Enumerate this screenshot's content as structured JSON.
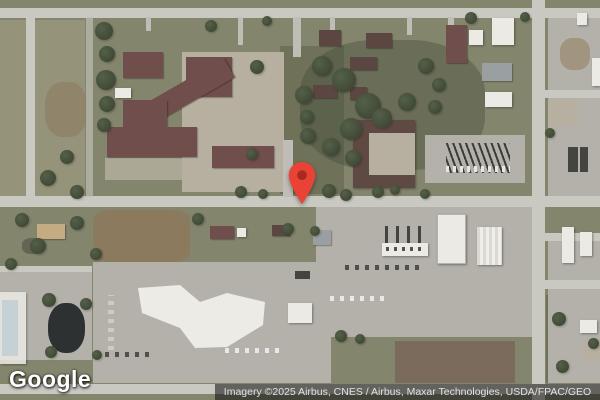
{
  "branding": {
    "logo_text": "Google"
  },
  "attribution": {
    "text": "Imagery ©2025 Airbus, CNES / Airbus, Maxar Technologies, USDA/FPAC/GEO"
  },
  "marker": {
    "color": "#EA4335",
    "dot_color": "#A52B1E"
  },
  "colors": {
    "grass": "#84856d",
    "road": "#c9c8c1",
    "parking": "#b3b1a9",
    "dirt_field": "#8c7a5f",
    "building_roof": "#6f4e4b",
    "building_white": "#eceae4",
    "tree": "#3f4833",
    "pond": "#2d3132",
    "attribution_bg": "rgba(15,15,15,0.55)",
    "attribution_text": "#e2e2e2",
    "logo_text": "#ffffff"
  }
}
